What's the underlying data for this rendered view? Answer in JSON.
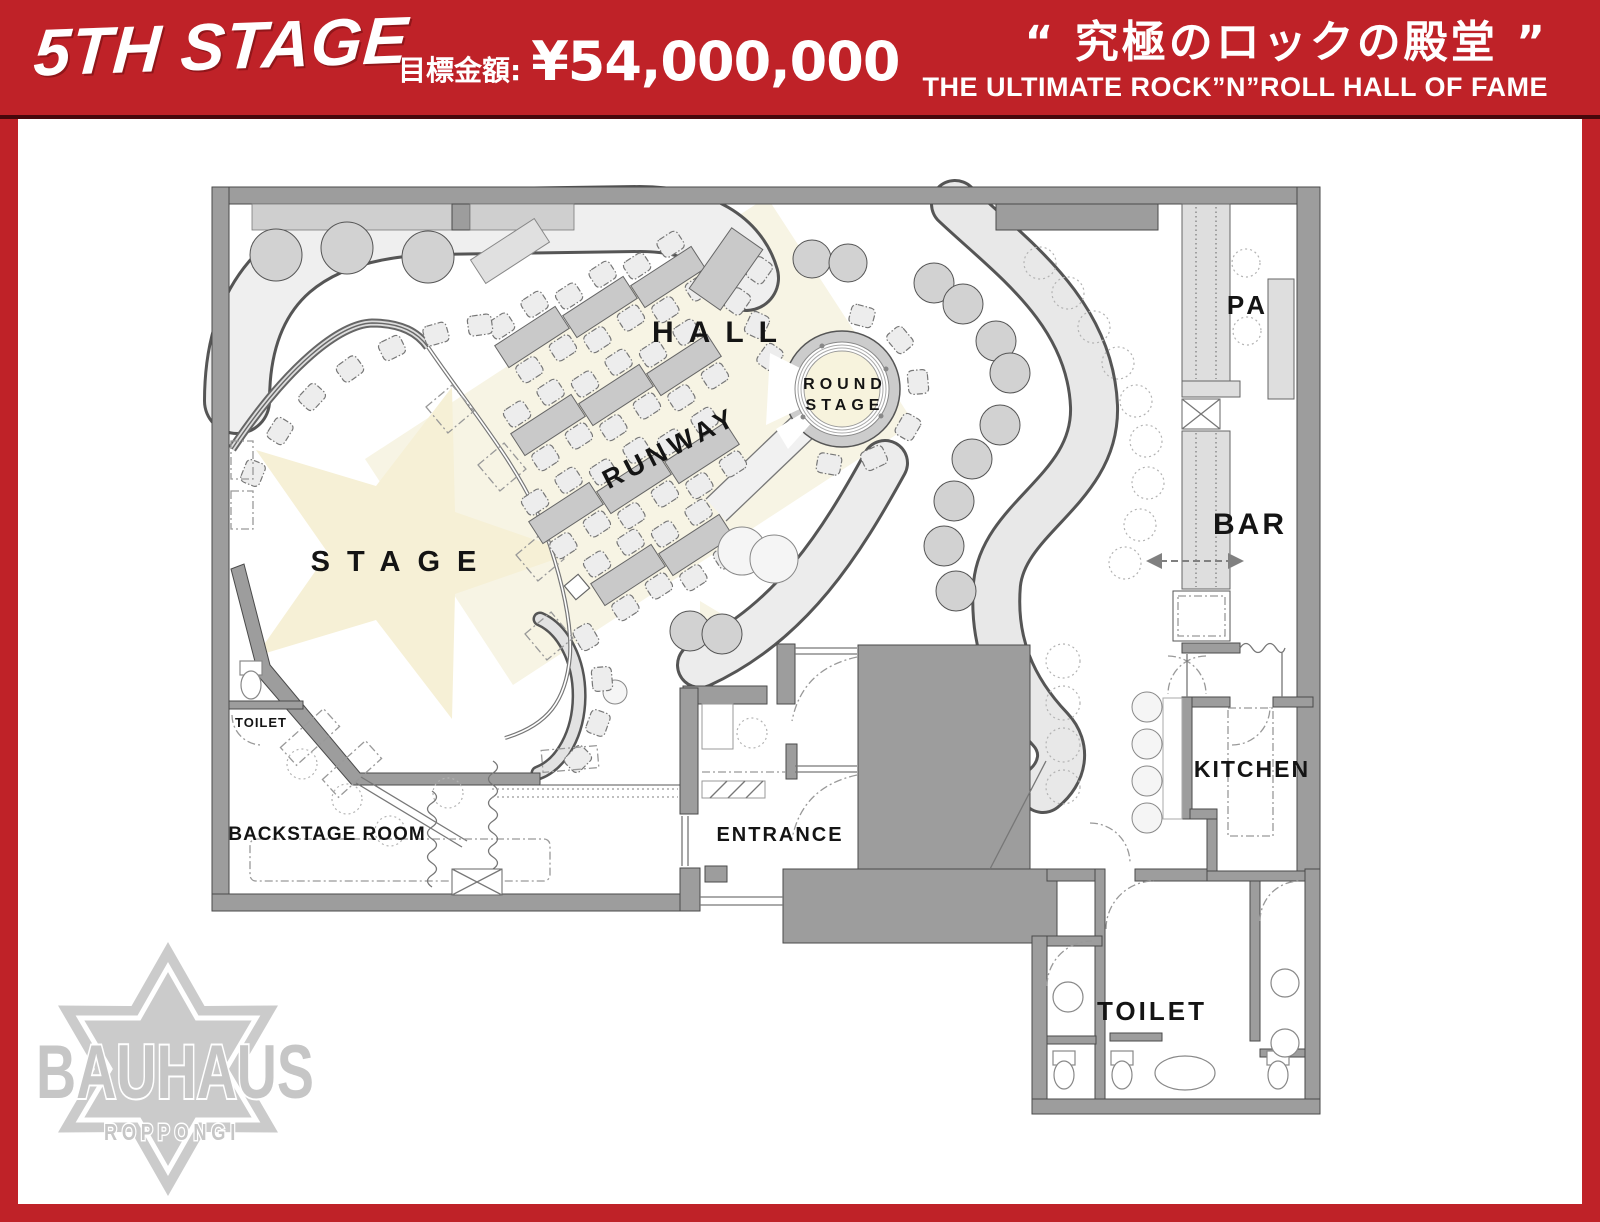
{
  "header": {
    "title": "5TH STAGE",
    "goal_label": "目標金額:",
    "goal_amount": "¥54,000,000",
    "tagline_jp": "“ 究極のロックの殿堂 ”",
    "tagline_en": "THE ULTIMATE ROCK”N”ROLL HALL OF FAME"
  },
  "floorplan": {
    "rooms": {
      "stage": "STAGE",
      "hall": "HALL",
      "runway": "RUNWAY",
      "round_stage": [
        "ROUND",
        "STAGE"
      ],
      "pa": "PA",
      "bar": "BAR",
      "kitchen": "KITCHEN",
      "toilet": "TOILET",
      "toilet_small": "TOILET",
      "backstage": "BACKSTAGE ROOM",
      "entrance": "ENTRANCE"
    }
  },
  "logo": {
    "brand": "BAUHAUS",
    "location": "ROPPONGI"
  },
  "colors": {
    "accent_red": "#bf2228",
    "wall_gray": "#9d9d9d",
    "stage_cream": "#f7f3df",
    "logo_gray": "#c9c9c9"
  }
}
